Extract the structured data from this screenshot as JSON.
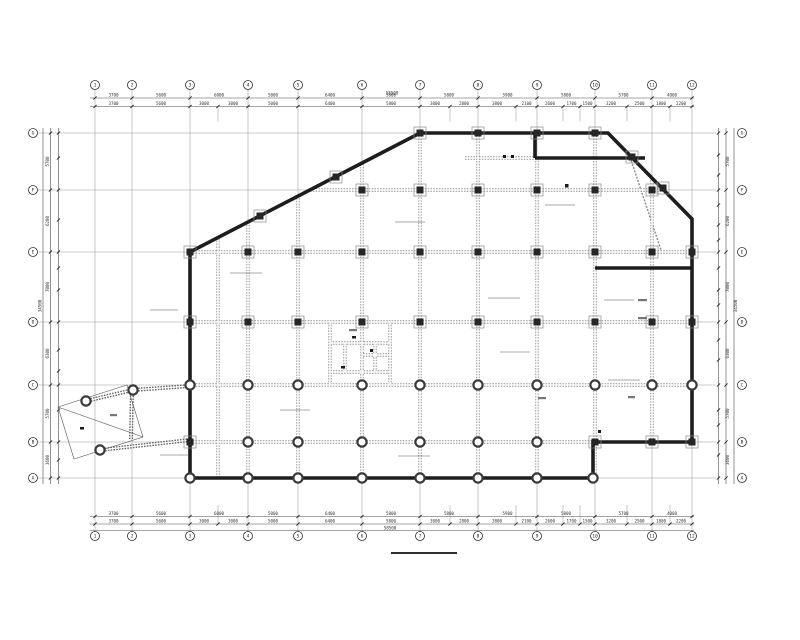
{
  "drawing": {
    "type": "structural-framing-floor-plan",
    "colors": {
      "paper": "#ffffff",
      "wall": "#1d1d1d",
      "beam": "#969696",
      "grid": "#9a9a9a",
      "column": "#262626"
    },
    "grid": {
      "cols": [
        {
          "label": "1",
          "x": 95
        },
        {
          "label": "2",
          "x": 132
        },
        {
          "label": "3",
          "x": 190
        },
        {
          "label": "4",
          "x": 248
        },
        {
          "label": "5",
          "x": 298
        },
        {
          "label": "6",
          "x": 362
        },
        {
          "label": "7",
          "x": 420
        },
        {
          "label": "8",
          "x": 478
        },
        {
          "label": "9",
          "x": 537
        },
        {
          "label": "10",
          "x": 595
        },
        {
          "label": "11",
          "x": 652
        },
        {
          "label": "12",
          "x": 692
        }
      ],
      "rows": [
        {
          "label": "G",
          "y": 133
        },
        {
          "label": "F",
          "y": 190
        },
        {
          "label": "E",
          "y": 252
        },
        {
          "label": "D",
          "y": 322
        },
        {
          "label": "C",
          "y": 385
        },
        {
          "label": "B",
          "y": 442
        },
        {
          "label": "A",
          "y": 478
        }
      ],
      "sub_cols": [
        218,
        450,
        516,
        563,
        580,
        627,
        670
      ],
      "col_extent": [
        89,
        532
      ],
      "row_extent": [
        38,
        716
      ],
      "bubble_rows": {
        "top_y": 85,
        "bottom_y": 536,
        "left_x": 33,
        "right_x": 742,
        "radius": 4.5
      }
    },
    "dims": {
      "top": {
        "line1_y": 98,
        "line2_y": 106.5,
        "row1": [
          {
            "a": 95,
            "b": 132,
            "t": "3700"
          },
          {
            "a": 132,
            "b": 190,
            "t": "5600"
          },
          {
            "a": 190,
            "b": 248,
            "t": "6000"
          },
          {
            "a": 248,
            "b": 298,
            "t": "5000"
          },
          {
            "a": 298,
            "b": 362,
            "t": "6400"
          },
          {
            "a": 362,
            "b": 420,
            "t": "5800"
          },
          {
            "a": 420,
            "b": 478,
            "t": "5800"
          },
          {
            "a": 478,
            "b": 537,
            "t": "5900"
          },
          {
            "a": 537,
            "b": 595,
            "t": "5800"
          },
          {
            "a": 595,
            "b": 652,
            "t": "5700"
          },
          {
            "a": 652,
            "b": 692,
            "t": "4000"
          }
        ],
        "row2": [
          {
            "a": 95,
            "b": 132,
            "t": "3700"
          },
          {
            "a": 132,
            "b": 190,
            "t": "5600"
          },
          {
            "a": 190,
            "b": 218,
            "t": "3000"
          },
          {
            "a": 218,
            "b": 248,
            "t": "3000"
          },
          {
            "a": 248,
            "b": 298,
            "t": "5000"
          },
          {
            "a": 298,
            "b": 362,
            "t": "6400"
          },
          {
            "a": 362,
            "b": 420,
            "t": "5800"
          },
          {
            "a": 420,
            "b": 450,
            "t": "3000"
          },
          {
            "a": 450,
            "b": 478,
            "t": "2800"
          },
          {
            "a": 478,
            "b": 516,
            "t": "3800"
          },
          {
            "a": 516,
            "b": 537,
            "t": "2100"
          },
          {
            "a": 537,
            "b": 563,
            "t": "2600"
          },
          {
            "a": 563,
            "b": 580,
            "t": "1700"
          },
          {
            "a": 580,
            "b": 595,
            "t": "1500"
          },
          {
            "a": 595,
            "b": 627,
            "t": "3200"
          },
          {
            "a": 627,
            "b": 652,
            "t": "2500"
          },
          {
            "a": 652,
            "b": 670,
            "t": "1800"
          },
          {
            "a": 670,
            "b": 692,
            "t": "2200"
          }
        ],
        "total": {
          "x": 392,
          "y": 94.5,
          "t": "58500"
        }
      },
      "bottom": {
        "line1_y": 516.5,
        "line2_y": 524,
        "total_line_y": 530.5,
        "total": {
          "x": 390,
          "y": 529.5,
          "t": "58500"
        }
      },
      "left": {
        "line1_x": 50.5,
        "line2_x": 58.5,
        "total_line_x": 43,
        "row": [
          {
            "a": 133,
            "b": 190,
            "t": "5700"
          },
          {
            "a": 190,
            "b": 252,
            "t": "6200"
          },
          {
            "a": 252,
            "b": 322,
            "t": "7000"
          },
          {
            "a": 322,
            "b": 385,
            "t": "6300"
          },
          {
            "a": 385,
            "b": 442,
            "t": "5700"
          },
          {
            "a": 442,
            "b": 478,
            "t": "3600"
          }
        ],
        "subs": [
          158,
          220,
          268,
          290,
          350,
          371,
          410,
          460
        ],
        "total": {
          "x": 43,
          "y": 306,
          "t": "34500"
        }
      },
      "right": {
        "line1_x": 726,
        "line2_x": 718.5,
        "total_line_x": 734,
        "subs": [
          155,
          175,
          205,
          225,
          240,
          268,
          290,
          305,
          340,
          360,
          410,
          425,
          455
        ],
        "total": {
          "x": 734,
          "y": 306,
          "t": "34500"
        }
      },
      "extent_x": [
        90,
        694
      ],
      "extent_y": [
        128,
        484
      ]
    },
    "plan": {
      "outline": [
        [
          190,
          252
        ],
        [
          420,
          133
        ],
        [
          608,
          133
        ],
        [
          692,
          219
        ],
        [
          692,
          442
        ],
        [
          593,
          442
        ],
        [
          593,
          478
        ],
        [
          190,
          478
        ],
        [
          190,
          252
        ]
      ],
      "interior_walls": [
        [
          535,
          133,
          535,
          158
        ],
        [
          535,
          158,
          645,
          158
        ],
        [
          595,
          268,
          692,
          268
        ]
      ],
      "beams": [
        [
          248,
          222,
          248,
          478
        ],
        [
          298,
          198,
          298,
          478
        ],
        [
          362,
          164,
          362,
          478
        ],
        [
          420,
          133,
          420,
          478
        ],
        [
          478,
          133,
          478,
          478
        ],
        [
          537,
          158,
          537,
          478
        ],
        [
          595,
          133,
          595,
          478
        ],
        [
          652,
          180,
          652,
          442
        ],
        [
          218,
          238,
          218,
          478
        ],
        [
          310,
          190,
          664,
          190
        ],
        [
          190,
          252,
          692,
          252
        ],
        [
          190,
          322,
          692,
          322
        ],
        [
          190,
          385,
          692,
          385
        ],
        [
          190,
          442,
          593,
          442
        ],
        [
          465,
          158,
          535,
          158
        ],
        [
          330,
          322,
          330,
          385
        ],
        [
          390,
          322,
          390,
          385
        ],
        [
          345,
          343,
          345,
          372
        ],
        [
          375,
          343,
          375,
          372
        ],
        [
          330,
          343,
          390,
          343
        ],
        [
          363,
          355,
          390,
          355
        ],
        [
          330,
          372,
          390,
          372
        ]
      ],
      "wing_beams": [
        [
          190,
          386,
          133,
          390
        ],
        [
          133,
          390,
          86,
          401
        ],
        [
          190,
          440,
          100,
          450
        ],
        [
          132,
          390,
          131,
          439
        ]
      ],
      "wing_polygon": [
        [
          58,
          407
        ],
        [
          127,
          385
        ],
        [
          143,
          437
        ],
        [
          74,
          459
        ]
      ],
      "wing_diagonal": [
        58,
        407,
        143,
        437
      ],
      "braces": [
        [
          628,
          151,
          661,
          250
        ]
      ],
      "columns": [
        [
          420,
          133,
          "s"
        ],
        [
          478,
          133,
          "s"
        ],
        [
          537,
          133,
          "s"
        ],
        [
          595,
          133,
          "s"
        ],
        [
          362,
          190,
          "s"
        ],
        [
          420,
          190,
          "s"
        ],
        [
          478,
          190,
          "s"
        ],
        [
          537,
          190,
          "s"
        ],
        [
          595,
          190,
          "s"
        ],
        [
          652,
          190,
          "s"
        ],
        [
          190,
          252,
          "s"
        ],
        [
          248,
          252,
          "s"
        ],
        [
          298,
          252,
          "s"
        ],
        [
          362,
          252,
          "s"
        ],
        [
          420,
          252,
          "s"
        ],
        [
          478,
          252,
          "s"
        ],
        [
          537,
          252,
          "s"
        ],
        [
          595,
          252,
          "s"
        ],
        [
          652,
          252,
          "s"
        ],
        [
          692,
          252,
          "s"
        ],
        [
          190,
          322,
          "s"
        ],
        [
          248,
          322,
          "s"
        ],
        [
          298,
          322,
          "s"
        ],
        [
          362,
          322,
          "s"
        ],
        [
          420,
          322,
          "s"
        ],
        [
          478,
          322,
          "s"
        ],
        [
          537,
          322,
          "s"
        ],
        [
          595,
          322,
          "s"
        ],
        [
          652,
          322,
          "s"
        ],
        [
          692,
          322,
          "s"
        ],
        [
          190,
          385,
          "c"
        ],
        [
          248,
          385,
          "c"
        ],
        [
          298,
          385,
          "c"
        ],
        [
          362,
          385,
          "c"
        ],
        [
          420,
          385,
          "c"
        ],
        [
          478,
          385,
          "c"
        ],
        [
          537,
          385,
          "c"
        ],
        [
          595,
          385,
          "c"
        ],
        [
          652,
          385,
          "c"
        ],
        [
          692,
          385,
          "c"
        ],
        [
          190,
          442,
          "s"
        ],
        [
          248,
          442,
          "c"
        ],
        [
          298,
          442,
          "c"
        ],
        [
          362,
          442,
          "c"
        ],
        [
          420,
          442,
          "c"
        ],
        [
          478,
          442,
          "c"
        ],
        [
          537,
          442,
          "c"
        ],
        [
          595,
          442,
          "s"
        ],
        [
          652,
          442,
          "s"
        ],
        [
          692,
          442,
          "s"
        ],
        [
          190,
          478,
          "c"
        ],
        [
          248,
          478,
          "c"
        ],
        [
          298,
          478,
          "c"
        ],
        [
          362,
          478,
          "c"
        ],
        [
          420,
          478,
          "c"
        ],
        [
          478,
          478,
          "c"
        ],
        [
          537,
          478,
          "c"
        ],
        [
          593,
          478,
          "c"
        ],
        [
          632,
          157,
          "s"
        ],
        [
          663,
          188,
          "s"
        ],
        [
          260,
          216,
          "s"
        ],
        [
          336,
          177,
          "s"
        ],
        [
          86,
          401,
          "c"
        ],
        [
          133,
          390,
          "c"
        ],
        [
          100,
          450,
          "c"
        ]
      ],
      "leaders": [
        [
          230,
          273,
          262,
          273
        ],
        [
          150,
          310,
          178,
          310
        ],
        [
          395,
          222,
          425,
          222
        ],
        [
          488,
          298,
          520,
          298
        ],
        [
          604,
          300,
          634,
          300
        ],
        [
          608,
          380,
          640,
          380
        ],
        [
          398,
          456,
          430,
          456
        ],
        [
          280,
          410,
          310,
          410
        ],
        [
          500,
          352,
          530,
          352
        ],
        [
          160,
          455,
          188,
          455
        ],
        [
          545,
          205,
          575,
          205
        ]
      ],
      "marks": [
        [
          503,
          155,
          3,
          3,
          "mark"
        ],
        [
          511,
          155,
          3,
          3,
          "mark"
        ],
        [
          565,
          184,
          3.5,
          3.5,
          "mark"
        ],
        [
          352,
          336,
          4,
          2.5,
          "mark"
        ],
        [
          341,
          366,
          4,
          2.5,
          "mark"
        ],
        [
          598,
          430,
          3,
          3,
          "mark"
        ],
        [
          80,
          427,
          4,
          2.5,
          "mark"
        ],
        [
          370,
          349,
          3,
          3,
          "mark"
        ],
        [
          349,
          329,
          8,
          2.2,
          "blob"
        ],
        [
          638,
          299,
          9,
          2.2,
          "blob"
        ],
        [
          638,
          317,
          9,
          2.2,
          "blob"
        ],
        [
          110,
          414,
          7,
          2.2,
          "blob"
        ],
        [
          538,
          397,
          8,
          2.2,
          "blob"
        ],
        [
          628,
          396,
          7,
          2.2,
          "blob"
        ]
      ]
    },
    "title": {
      "underline": {
        "x1": 391,
        "y": 553,
        "x2": 457
      }
    }
  }
}
